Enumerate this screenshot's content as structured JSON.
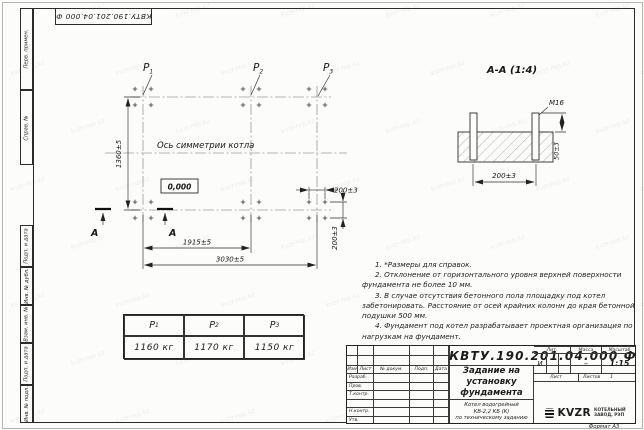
{
  "watermark": {
    "text": "kvzr-rep.kz"
  },
  "sheet": {
    "doc_number_top": "КВТУ.190.201.04.000 Ф",
    "format_label": "Формат А3",
    "margin_top_labels": [
      "Перв. примен.",
      "Справ. №"
    ],
    "margin_bottom_labels": [
      "Подп. и дата",
      "Инв. № дубл.",
      "Взам. инв. №",
      "Подп. и дата",
      "Инв. № подл."
    ]
  },
  "plan": {
    "axis_label": "Ось симметрии котла",
    "level_mark": "0,000",
    "section_letter": "А",
    "p_labels": [
      {
        "base": "P",
        "sub": "1"
      },
      {
        "base": "P",
        "sub": "2"
      },
      {
        "base": "P",
        "sub": "3"
      }
    ],
    "dim_height": "1360±5",
    "dim_width_mid": "1915±5",
    "dim_width_total": "3030±5",
    "dim_bolt_h": "200±3",
    "dim_bolt_v": "200±3"
  },
  "section": {
    "title": "А-А (1:4)",
    "thread_label": "М16",
    "dim_bolt_spacing": "200±3",
    "dim_protrusion": "50±3"
  },
  "notes": [
    "1. *Размеры для справок.",
    "2. Отклонение от горизонтального уровня верхней поверхности фундамента не более 10 мм.",
    "3. В случае отсутствия бетонного пола площадку под котел забетонировать. Расстояние от осей крайних колонн до края бетонной подушки 500 мм.",
    "4. Фундамент под котел разрабатывает проектная организация по нагрузкам на фундамент."
  ],
  "load_table": {
    "headers": [
      {
        "base": "P",
        "sub": "1"
      },
      {
        "base": "P",
        "sub": "2"
      },
      {
        "base": "P",
        "sub": "3"
      }
    ],
    "values": [
      "1160 кг",
      "1170 кг",
      "1150 кг"
    ]
  },
  "title_block": {
    "doc_number": "КВТУ.190.201.04.000 Ф",
    "title_lines": [
      "Задание на",
      "установку",
      "фундамента"
    ],
    "product_lines": [
      "Котел водогрейный",
      "КВ-2,2 КБ (К)",
      "по техническому заданию"
    ],
    "header_cells": [
      "Изм",
      "Лист",
      "№ докум.",
      "Подп.",
      "Дата"
    ],
    "role_rows": [
      "Разраб.",
      "Пров.",
      "Т.контр.",
      "",
      "Н.контр.",
      "Утв."
    ],
    "lit_label": "Лит.",
    "lit_value": "И",
    "mass_label": "Масса",
    "mass_value": "–",
    "scale_label": "Масштаб",
    "scale_value": "1:15",
    "sheet_label": "Лист",
    "sheets_label": "Листов",
    "sheets_value": "1",
    "logo_text": "KVZR",
    "company_lines": [
      "КОТЕЛЬНЫЙ",
      "ЗАВОД, РЭП"
    ]
  }
}
